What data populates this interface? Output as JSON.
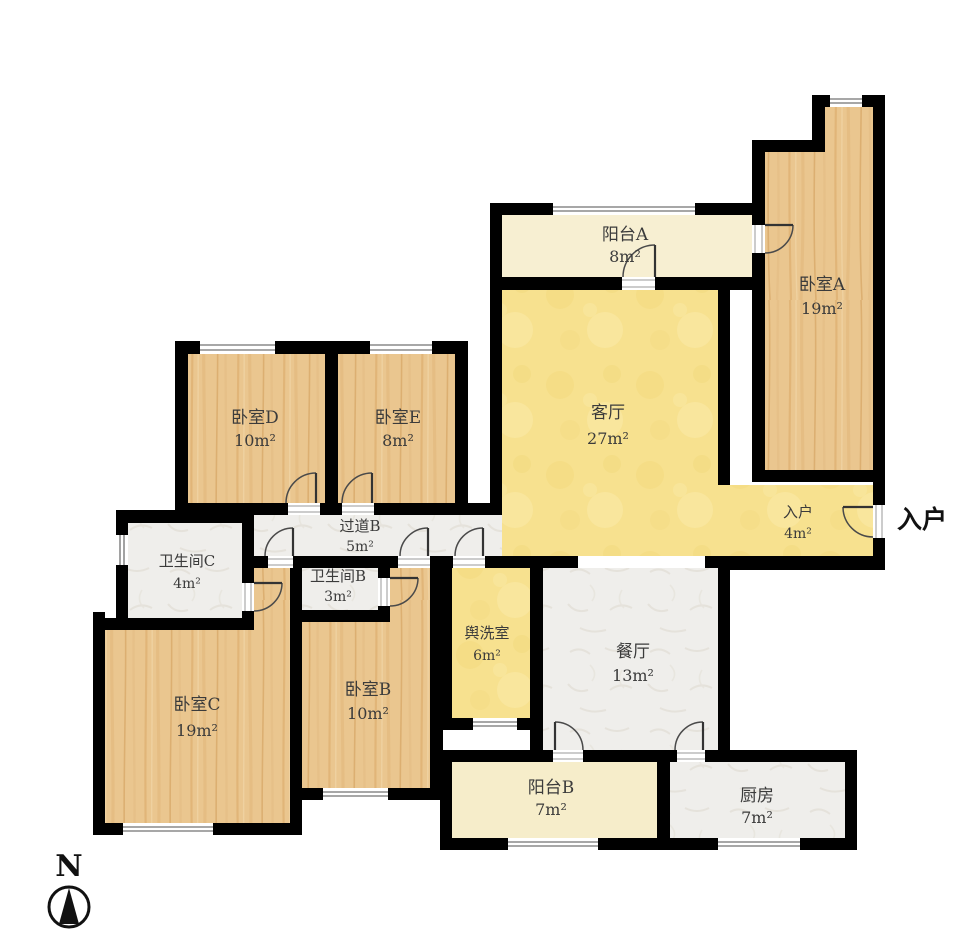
{
  "type": "floor-plan",
  "compass": {
    "label": "N"
  },
  "entry_arrow_label": "入户",
  "rooms": [
    {
      "id": "balcony_a",
      "name": "阳台A",
      "area": "8m²"
    },
    {
      "id": "bedroom_a",
      "name": "卧室A",
      "area": "19m²"
    },
    {
      "id": "living",
      "name": "客厅",
      "area": "27m²"
    },
    {
      "id": "entry",
      "name": "入户",
      "area": "4m²"
    },
    {
      "id": "bedroom_d",
      "name": "卧室D",
      "area": "10m²"
    },
    {
      "id": "bedroom_e",
      "name": "卧室E",
      "area": "8m²"
    },
    {
      "id": "hallway_b",
      "name": "过道B",
      "area": "5m²"
    },
    {
      "id": "bath_c",
      "name": "卫生间C",
      "area": "4m²"
    },
    {
      "id": "bath_b",
      "name": "卫生间B",
      "area": "3m²"
    },
    {
      "id": "washroom",
      "name": "舆洗室",
      "area": "6m²"
    },
    {
      "id": "dining",
      "name": "餐厅",
      "area": "13m²"
    },
    {
      "id": "bedroom_c",
      "name": "卧室C",
      "area": "19m²"
    },
    {
      "id": "bedroom_b",
      "name": "卧室B",
      "area": "10m²"
    },
    {
      "id": "balcony_b",
      "name": "阳台B",
      "area": "7m²"
    },
    {
      "id": "kitchen",
      "name": "厨房",
      "area": "7m²"
    }
  ],
  "colors": {
    "wall": "#000000",
    "wood_floor": "#eac68f",
    "wood_grain": "#d9a866",
    "living_yellow": "#f7e18f",
    "balcony_cream": "#f7efd2",
    "tile_gray": "#efeeeb",
    "window_line": "#8a8a8a",
    "door_arc": "#4a4a4a"
  }
}
